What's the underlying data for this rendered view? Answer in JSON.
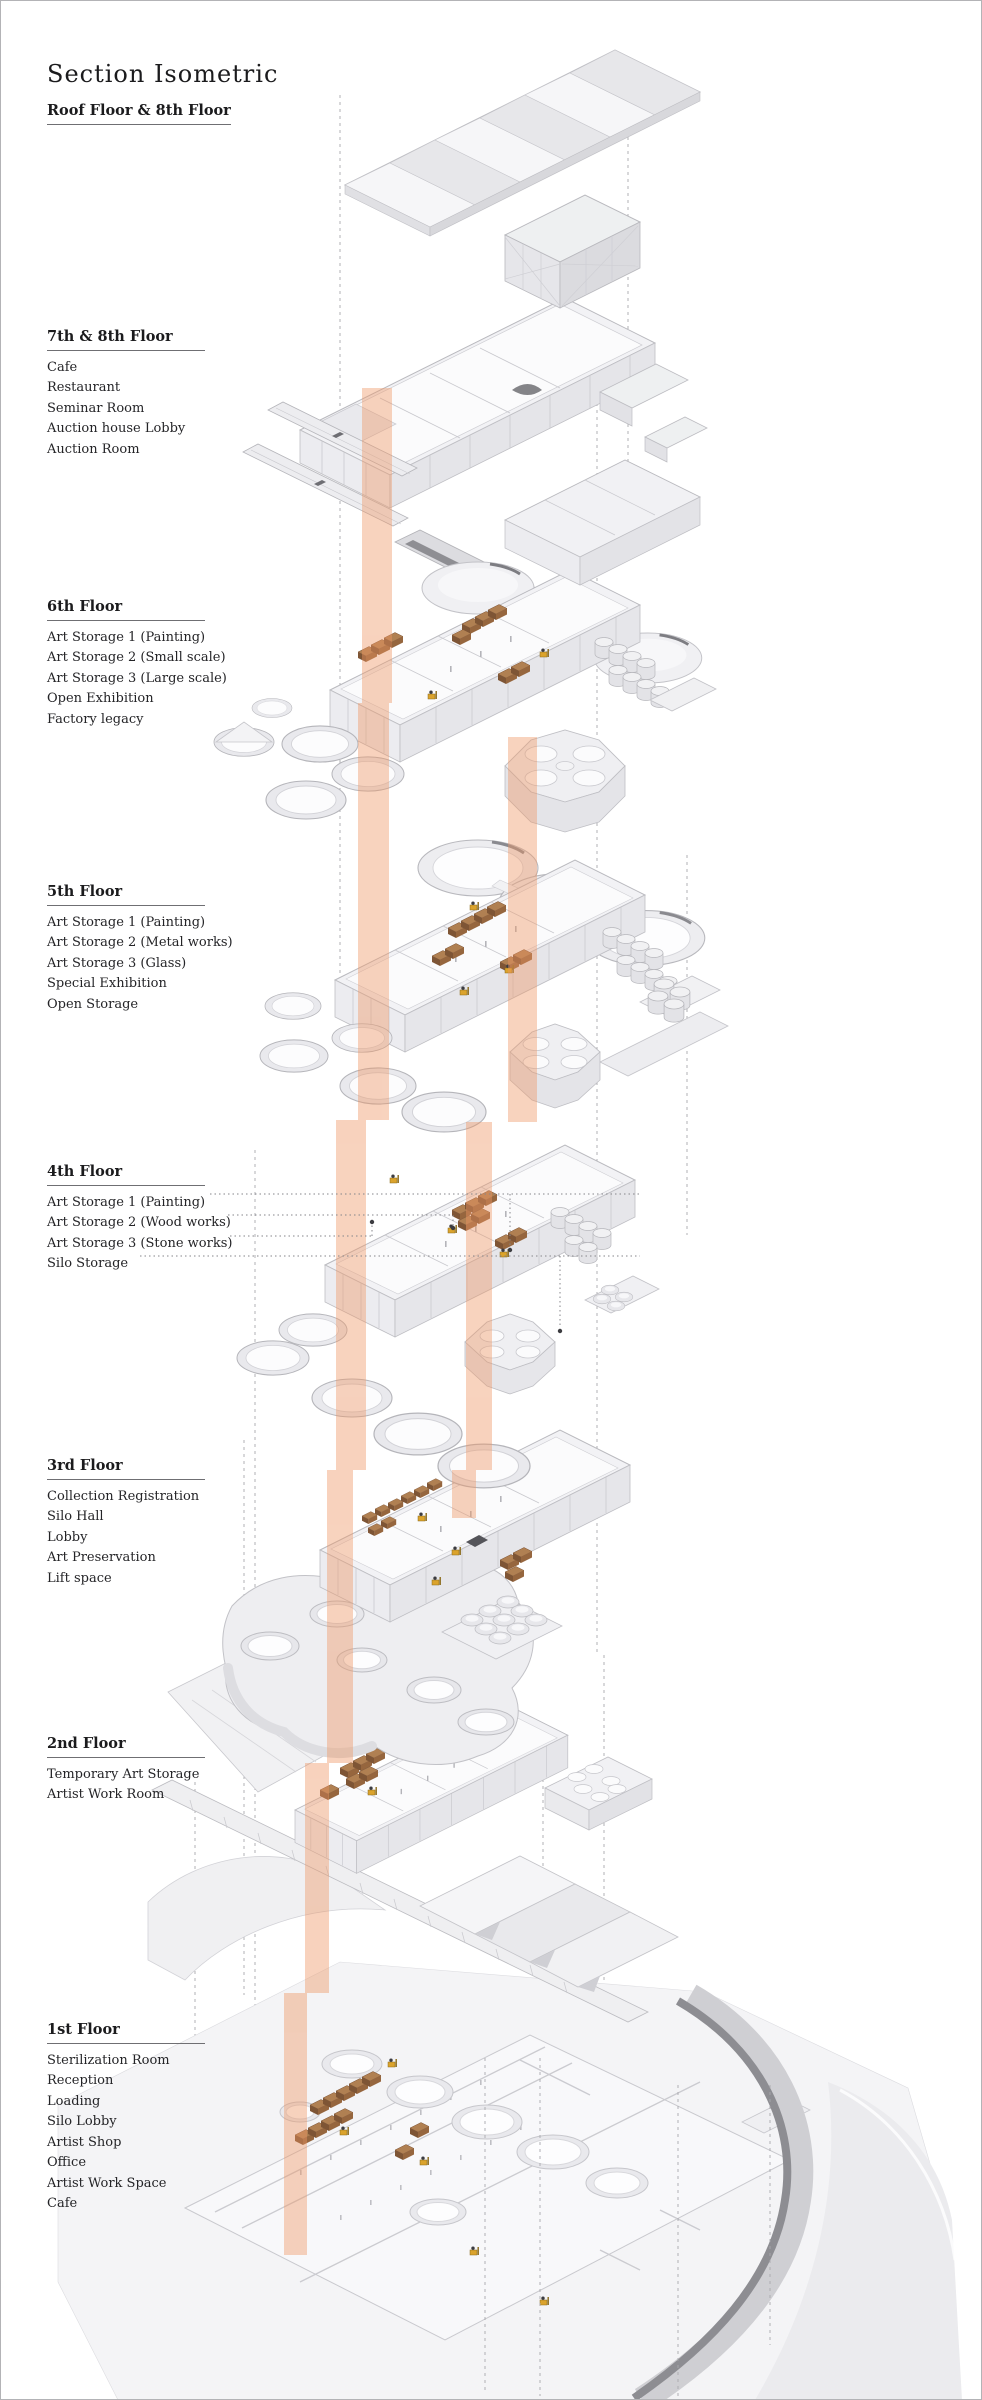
{
  "page": {
    "title": "Section Isometric"
  },
  "floors": [
    {
      "name": "Roof Floor & 8th Floor",
      "rooms": []
    },
    {
      "name": "7th & 8th Floor",
      "rooms": [
        "Cafe",
        "Restaurant",
        "Seminar Room",
        "Auction house Lobby",
        "Auction Room"
      ]
    },
    {
      "name": "6th Floor",
      "rooms": [
        "Art Storage 1 (Painting)",
        "Art Storage 2 (Small scale)",
        "Art Storage 3 (Large scale)",
        "Open Exhibition",
        "Factory legacy"
      ]
    },
    {
      "name": "5th Floor",
      "rooms": [
        "Art Storage 1 (Painting)",
        "Art Storage 2 (Metal works)",
        "Art Storage 3 (Glass)",
        "Special Exhibition",
        "Open Storage"
      ]
    },
    {
      "name": "4th Floor",
      "rooms": [
        "Art Storage 1 (Painting)",
        "Art Storage 2 (Wood works)",
        "Art Storage 3 (Stone works)",
        "Silo Storage"
      ]
    },
    {
      "name": "3rd Floor",
      "rooms": [
        "Collection Registration",
        "Silo Hall",
        "Lobby",
        "Art Preservation",
        "Lift space"
      ]
    },
    {
      "name": "2nd Floor",
      "rooms": [
        "Temporary Art Storage",
        "Artist Work Room"
      ]
    },
    {
      "name": "1st Floor",
      "rooms": [
        "Sterilization Room",
        "Reception",
        "Loading",
        "Silo Lobby",
        "Artist Shop",
        "Office",
        "Artist Work Space",
        "Cafe"
      ]
    }
  ],
  "colors": {
    "ink": "#1b1b1d",
    "heading_rule": "#6f6f73",
    "guide_line": "#a8a8ad",
    "shaft_salmon": "#ef9663",
    "floor_fill": "#f2f2f5",
    "wall_fill": "#e6e6ea",
    "crate_brown": "#a06f48",
    "forklift_yellow": "#dba32c",
    "road_gray": "#8d8d92"
  }
}
